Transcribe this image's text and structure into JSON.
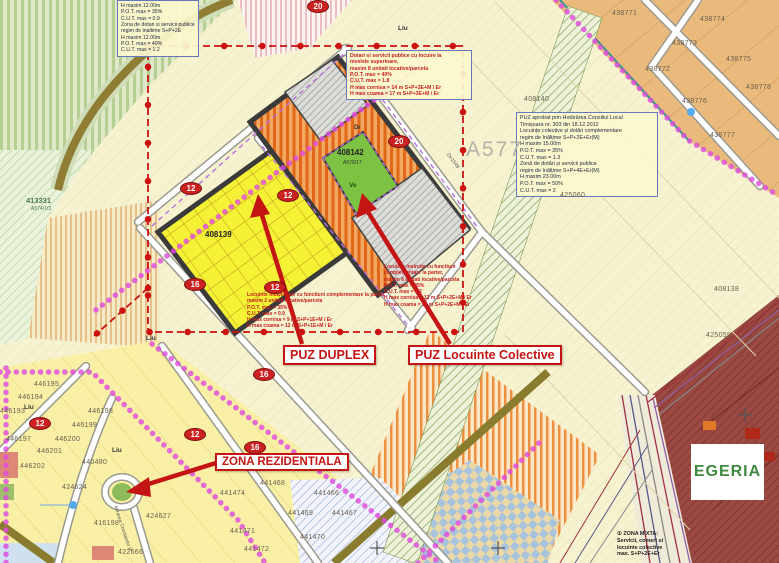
{
  "labels": {
    "puz_duplex": "PUZ DUPLEX",
    "puz_colective": "PUZ Locuinte Colective",
    "zona_rezidentiala": "ZONA REZIDENTIALA",
    "egeria": "EGERIA",
    "a577": "A577",
    "dr": "Dr",
    "ve": "Ve",
    "de_road": "De1549",
    "street_intrarea": "Intrarea Constantin P.",
    "liu": "Liu",
    "parcel_408139": "408139",
    "parcel_408142": "408142",
    "parcel_408142_sub": "A579/17",
    "parcel_413331": "413331",
    "parcel_413331_sub": "A574/1/3"
  },
  "road_markers": [
    {
      "label": "20"
    },
    {
      "label": "20"
    },
    {
      "label": "12"
    },
    {
      "label": "12"
    },
    {
      "label": "16"
    },
    {
      "label": "12"
    },
    {
      "label": "16"
    },
    {
      "label": "12"
    },
    {
      "label": "12"
    },
    {
      "label": "16"
    }
  ],
  "parcel_numbers": [
    {
      "label": "438771"
    },
    {
      "label": "438774"
    },
    {
      "label": "438773"
    },
    {
      "label": "438772"
    },
    {
      "label": "438775"
    },
    {
      "label": "438776"
    },
    {
      "label": "438778"
    },
    {
      "label": "438777"
    },
    {
      "label": "408140"
    },
    {
      "label": "425060"
    },
    {
      "label": "425059"
    },
    {
      "label": "408138"
    },
    {
      "label": "446195"
    },
    {
      "label": "446194"
    },
    {
      "label": "446193"
    },
    {
      "label": "446197"
    },
    {
      "label": "446198"
    },
    {
      "label": "446199"
    },
    {
      "label": "446200"
    },
    {
      "label": "446201"
    },
    {
      "label": "446202"
    },
    {
      "label": "440480"
    },
    {
      "label": "424624"
    },
    {
      "label": "416198"
    },
    {
      "label": "424627"
    },
    {
      "label": "422666"
    },
    {
      "label": "441474"
    },
    {
      "label": "441468"
    },
    {
      "label": "441466"
    },
    {
      "label": "441469"
    },
    {
      "label": "441467"
    },
    {
      "label": "441471"
    },
    {
      "label": "441470"
    },
    {
      "label": "441472"
    }
  ],
  "reg_top_left": {
    "lines": [
      "H maxim 12.00m",
      "P.O.T. max = 35%",
      "C.U.T. max = 0.9",
      "Zona de dotari si servicii publice",
      "regim de inaltime S+P+2E",
      "H maxim 12.00m",
      "P.O.T. max = 40%",
      "C.U.T. max = 1.2"
    ]
  },
  "reg_top_center": {
    "lines": [
      "Dotari si servicii publice cu locuire la",
      "nivelele superioare,",
      "maxim 8 unitati locative/parcela",
      "P.O.T. max = 40%",
      "C.U.T. max = 1.8",
      "H max cornisa = 14 m S+P+3E+M / Er",
      "H max coama = 17 m S+P+3E+M / Er"
    ]
  },
  "reg_right": {
    "lines": [
      "PUZ aprobat prin Hotărârea Consiliul Local",
      "Timișoara nr. 303 din 18.12.2012",
      "Locuințe colective și dotări complementare",
      "regim de înălțime S+P+2E+Er(M)",
      "H maxim 15.00m",
      "P.O.T. max = 35%",
      "C.U.T. max = 1.3",
      "Zonă de dotări și servicii publice",
      "regim de înălțime S+P+4E+Er(M)",
      "H maxim 23.00m",
      "P.O.T. max = 50%",
      "C.U.T. max = 2"
    ]
  },
  "reg_center": {
    "lines": [
      "Locuinte insiruite cu functiuni",
      "complementare la parter,",
      "maxim 6 unitati locative/parcela",
      "P.O.T. max = 35%",
      "C.U.T. max = 1.2",
      "H max cornisa = 12 m S+P+2E+M / Er",
      "H max coama = 15 m S+P+2E+M / Er"
    ]
  },
  "reg_yellow": {
    "lines": [
      "Locuinte individuale cu functiuni complementare la parter",
      "maxim 2 unitati locative/parcela",
      "P.O.T. max = 35%",
      "C.U.T. max = 0.9",
      "H max cornisa = 9 m S+P+1E+M / Er",
      "H max coama = 12 m S+P+1E+M / Er"
    ]
  },
  "zona_mixta": {
    "bullet": "①",
    "lines": [
      "ZONA MIXTA:",
      "Servicii, comert si",
      "locuinte colective",
      "max. S+P+2E+Er"
    ]
  },
  "colors": {
    "puz_boundary": "#cc1111",
    "magenta_boundary": "#df4adf",
    "egeria_green": "#3f8a3f",
    "yellow_zone": "#f5f235",
    "orange_zone": "#f2a860",
    "green_parcel": "#7dc242",
    "egeria_zone": "#9a4a42"
  }
}
